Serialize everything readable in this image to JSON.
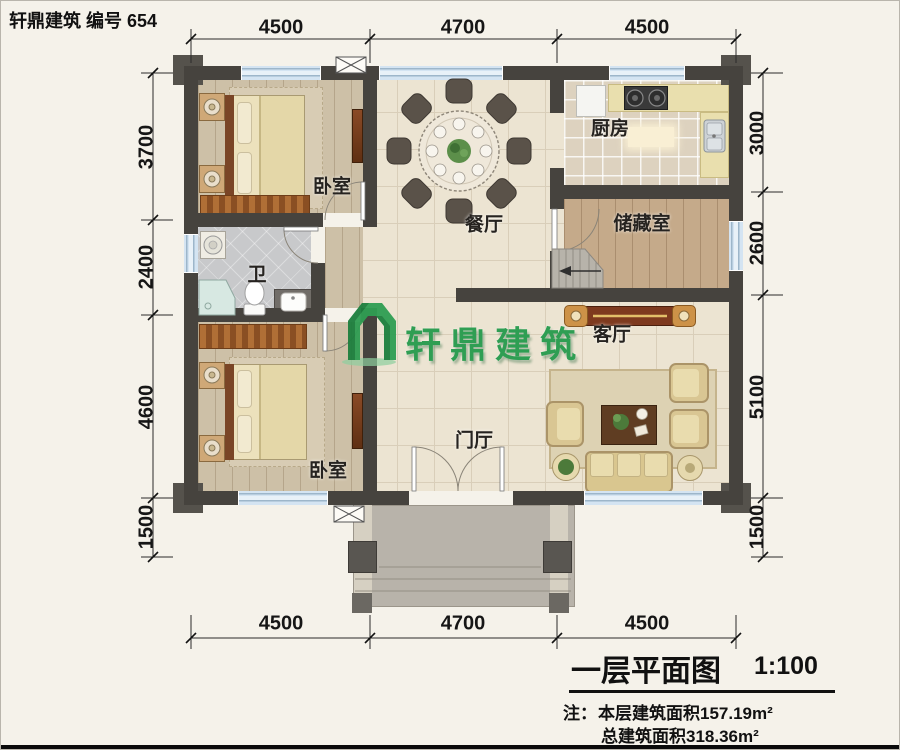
{
  "header": {
    "title": "轩鼎建筑 编号 654"
  },
  "rooms": {
    "bedroom_top": "卧室",
    "bedroom_bottom": "卧室",
    "dining": "餐厅",
    "kitchen": "厨房",
    "storage": "储藏室",
    "bath": "卫",
    "living": "客厅",
    "foyer": "门厅"
  },
  "dims": {
    "top": [
      "4500",
      "4700",
      "4500"
    ],
    "bottom": [
      "4500",
      "4700",
      "4500"
    ],
    "left": [
      "3700",
      "2400",
      "4600",
      "1500"
    ],
    "right": [
      "3000",
      "2600",
      "5100",
      "1500"
    ]
  },
  "watermark": {
    "brand": "轩鼎建筑"
  },
  "footer": {
    "plan_name": "一层平面图",
    "scale": "1:100",
    "note_label": "注：",
    "note_line1": "本层建筑面积157.19m²",
    "note_line2": "总建筑面积318.36m²"
  },
  "colors": {
    "wall": "#46433e",
    "window_blue": "#d4e4f2",
    "logo_green": "#2f9e53",
    "floor_tile": "#ece4d2",
    "floor_wood": "#cdc0a7"
  }
}
